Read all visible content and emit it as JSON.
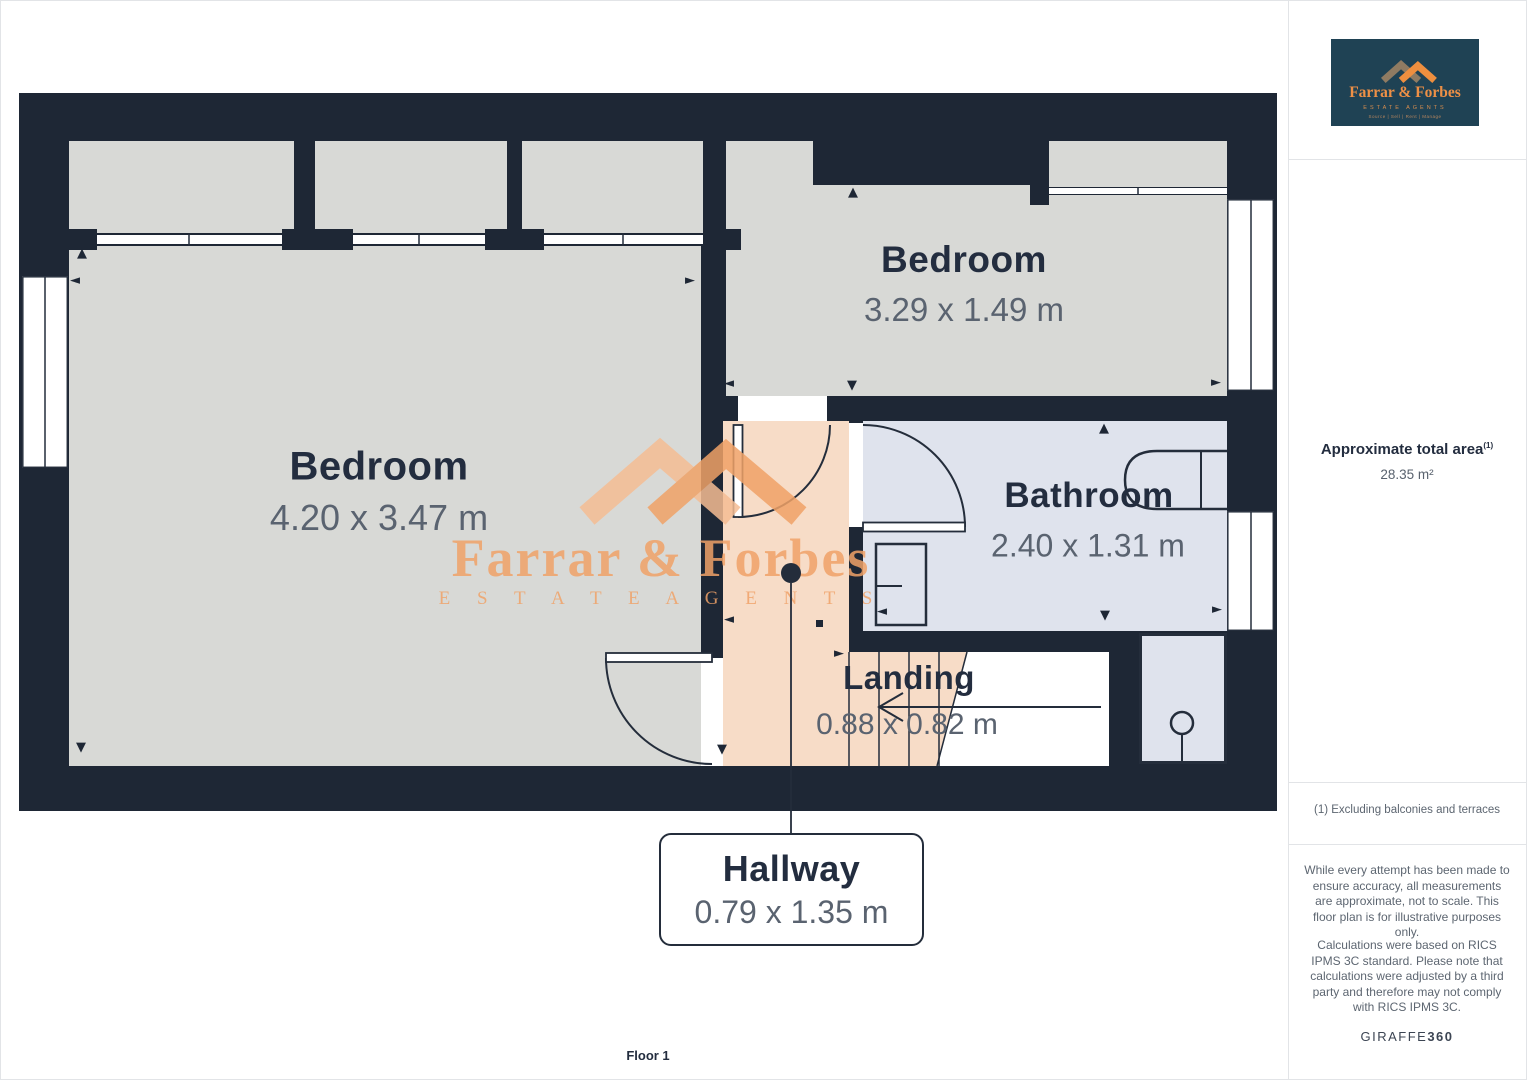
{
  "plan": {
    "floor_label": "Floor 1",
    "rooms": {
      "bedroom1": {
        "name": "Bedroom",
        "dims": "4.20 x 3.47 m"
      },
      "bedroom2": {
        "name": "Bedroom",
        "dims": "3.29 x 1.49 m"
      },
      "bathroom": {
        "name": "Bathroom",
        "dims": "2.40 x 1.31 m"
      },
      "landing": {
        "name": "Landing",
        "dims": "0.88 x 0.82 m"
      },
      "hallway": {
        "name": "Hallway",
        "dims": "0.79 x 1.35 m"
      }
    }
  },
  "watermark": {
    "name": "Farrar & Forbes",
    "tagline": "E S T A T E   A G E N T S"
  },
  "logo": {
    "name": "Farrar & Forbes",
    "tagline": "ESTATE AGENTS",
    "subtagline": "Source | Sell | Rent | Manage"
  },
  "sidebar": {
    "area_title": "Approximate total area",
    "area_title_sup": "(1)",
    "area_value": "28.35 m²",
    "footnote": "(1) Excluding balconies and terraces",
    "disclaimer1": "While every attempt has been made to ensure accuracy, all measurements are approximate, not to scale. This floor plan is for illustrative purposes only.",
    "disclaimer2": "Calculations were based on RICS IPMS 3C standard. Please note that calculations were adjusted by a third party and therefore may not comply with RICS IPMS 3C.",
    "brand": "GIRAFFE",
    "brand_suffix": "360"
  },
  "icons": {
    "arrow_up": "▲",
    "arrow_down": "▼",
    "arrow_left": "◄",
    "arrow_right": "►"
  },
  "colors": {
    "wall": "#1e2735",
    "room_gray": "#d8d9d6",
    "wet_room_blue": "#dfe3ed",
    "landing_peach": "#f7dcc7",
    "accent_orange": "#f0a268",
    "logo_background": "#1f4254"
  }
}
